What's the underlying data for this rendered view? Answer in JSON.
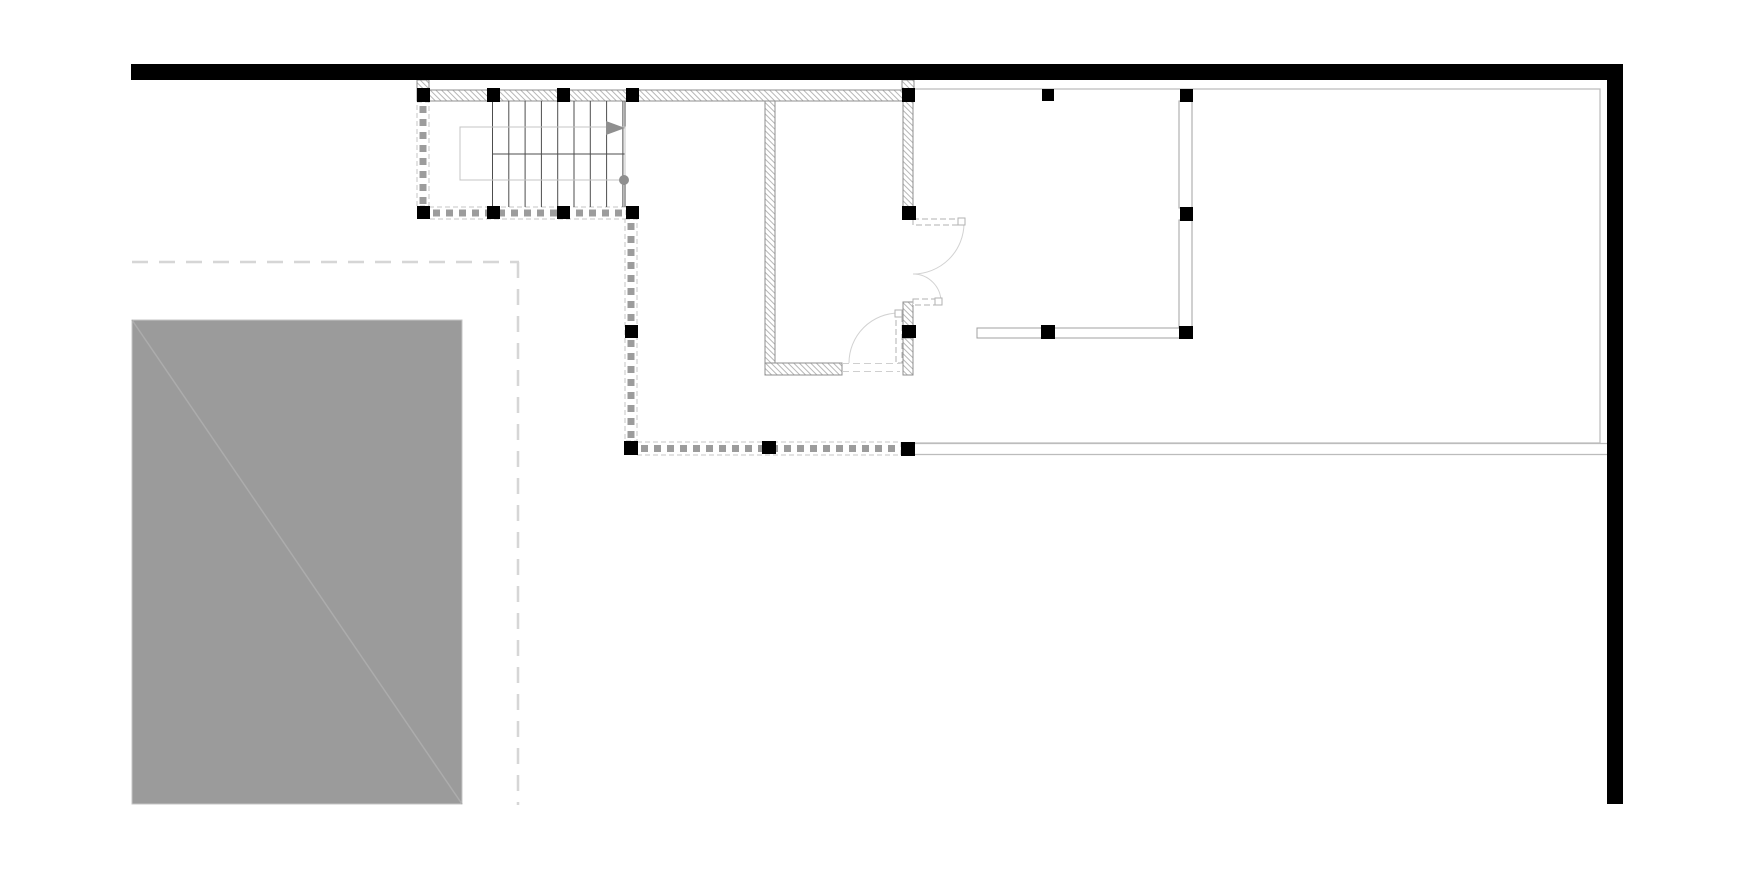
{
  "document": {
    "type": "architectural-floor-plan",
    "background": "#ffffff",
    "canvas": {
      "width": 1754,
      "height": 871
    }
  },
  "colors": {
    "black_wall": "#000000",
    "hatch_line": "#b7b7b7",
    "hatch_border": "#8f8f8f",
    "thin_wall_border": "#a0a0a0",
    "terrace_line": "#bcbcbc",
    "dash_border": "#c4c4c4",
    "dash_square": "#9c9c9c",
    "stair_line": "#4d4d4d",
    "railing_line": "#c4c4c4",
    "marker_gray": "#8f8f8f",
    "door_arc": "#d2d2d2",
    "door_leaf": "#b2b2b2",
    "threshold": "#cfcfcf",
    "site_dash": "#d6d6d6",
    "site_mass_fill": "#9b9b9b",
    "site_mass_diag": "#acacac",
    "site_mass_edge": "#c6c6c6"
  },
  "black_walls": [
    {
      "name": "exterior-wall-top",
      "x": 131,
      "y": 64,
      "w": 1492,
      "h": 16
    },
    {
      "name": "exterior-wall-right",
      "x": 1607,
      "y": 80,
      "w": 16,
      "h": 724
    }
  ],
  "hatched_walls": [
    {
      "name": "wall-connector-left",
      "x": 417,
      "y": 80,
      "w": 12,
      "h": 10
    },
    {
      "name": "wall-connector-mid",
      "x": 902,
      "y": 80,
      "w": 12,
      "h": 10
    },
    {
      "name": "wall-top-interior",
      "x": 417,
      "y": 90,
      "w": 497,
      "h": 11
    },
    {
      "name": "room-wall-left",
      "x": 765,
      "y": 101,
      "w": 10,
      "h": 274
    },
    {
      "name": "room-wall-bottom",
      "x": 765,
      "y": 363,
      "w": 77,
      "h": 12
    },
    {
      "name": "room-wall-right-upper",
      "x": 903,
      "y": 101,
      "w": 10,
      "h": 106
    },
    {
      "name": "room-wall-right-mid",
      "x": 903,
      "y": 302,
      "w": 10,
      "h": 24
    },
    {
      "name": "room-wall-right-lower",
      "x": 903,
      "y": 338,
      "w": 10,
      "h": 37
    }
  ],
  "thin_walls": [
    {
      "name": "partition-right-upper",
      "x": 1179,
      "y": 101,
      "w": 13,
      "h": 107
    },
    {
      "name": "partition-right-lower",
      "x": 1179,
      "y": 220,
      "w": 13,
      "h": 107
    },
    {
      "name": "partition-bottom",
      "x": 977,
      "y": 328,
      "w": 203,
      "h": 10
    }
  ],
  "terrace": {
    "outline": {
      "x": 914,
      "y": 89,
      "w": 686,
      "h": 354
    },
    "parapet_lines": [
      {
        "x1": 914,
        "y1": 443.5,
        "x2": 1607,
        "y2": 443.5
      },
      {
        "x1": 914,
        "y1": 454.5,
        "x2": 1607,
        "y2": 454.5
      }
    ]
  },
  "dashed_bands": [
    {
      "name": "dashed-wall-stair-left",
      "x": 417,
      "y": 102,
      "w": 12,
      "h": 104,
      "orient": "v"
    },
    {
      "name": "dashed-wall-stair-bottom",
      "x": 429,
      "y": 207,
      "w": 197,
      "h": 12,
      "orient": "h"
    },
    {
      "name": "dashed-wall-court-left",
      "x": 625,
      "y": 219,
      "w": 12,
      "h": 222,
      "orient": "v"
    },
    {
      "name": "dashed-wall-court-bottom",
      "x": 637,
      "y": 442,
      "w": 264,
      "h": 13,
      "orient": "h"
    }
  ],
  "columns": [
    {
      "x": 417,
      "y": 88,
      "w": 13,
      "h": 14
    },
    {
      "x": 487,
      "y": 88,
      "w": 13,
      "h": 14
    },
    {
      "x": 557,
      "y": 88,
      "w": 13,
      "h": 14
    },
    {
      "x": 626,
      "y": 88,
      "w": 13,
      "h": 14
    },
    {
      "x": 902,
      "y": 88,
      "w": 13,
      "h": 14
    },
    {
      "x": 1042,
      "y": 89,
      "w": 12,
      "h": 12
    },
    {
      "x": 1180,
      "y": 89,
      "w": 13,
      "h": 13
    },
    {
      "x": 417,
      "y": 206,
      "w": 13,
      "h": 13
    },
    {
      "x": 487,
      "y": 206,
      "w": 13,
      "h": 13
    },
    {
      "x": 557,
      "y": 206,
      "w": 13,
      "h": 13
    },
    {
      "x": 626,
      "y": 206,
      "w": 13,
      "h": 13
    },
    {
      "x": 902,
      "y": 206,
      "w": 14,
      "h": 14
    },
    {
      "x": 1180,
      "y": 207,
      "w": 13,
      "h": 14
    },
    {
      "x": 625,
      "y": 325,
      "w": 13,
      "h": 13
    },
    {
      "x": 902,
      "y": 325,
      "w": 14,
      "h": 13
    },
    {
      "x": 1041,
      "y": 325,
      "w": 14,
      "h": 14
    },
    {
      "x": 1179,
      "y": 326,
      "w": 14,
      "h": 13
    },
    {
      "x": 624,
      "y": 441,
      "w": 14,
      "h": 14
    },
    {
      "x": 762,
      "y": 441,
      "w": 14,
      "h": 13
    },
    {
      "x": 901,
      "y": 442,
      "w": 14,
      "h": 14
    }
  ],
  "stairs": {
    "treads": {
      "x_start": 492.5,
      "step": 16.3,
      "count": 9,
      "y1": 101,
      "y2": 207
    },
    "mid_line": {
      "x1": 492,
      "y1": 154,
      "x2": 625,
      "y2": 154
    },
    "right_edge": {
      "x1": 625,
      "y1": 101,
      "x2": 625,
      "y2": 207
    },
    "railing": {
      "x": 460,
      "y": 127,
      "w": 165,
      "h": 53
    },
    "direction_arrow": {
      "points": "606,121 625,128 606,135"
    },
    "start_marker": {
      "cx": 624,
      "cy": 180,
      "r": 5
    }
  },
  "doors": [
    {
      "name": "door-upper",
      "leaf": {
        "x": 913,
        "y": 219,
        "w": 51,
        "h": 6
      },
      "tip": {
        "x": 958,
        "y": 218,
        "w": 7,
        "h": 7
      },
      "arc": "M 964 223 A 51 51 0 0 1 913 274"
    },
    {
      "name": "door-mid",
      "leaf": {
        "x": 913,
        "y": 299,
        "w": 28,
        "h": 6
      },
      "tip": {
        "x": 935,
        "y": 298,
        "w": 7,
        "h": 7
      },
      "arc": "M 941 302 A 28 28 0 0 0 913 274"
    },
    {
      "name": "door-bottom",
      "leaf": {
        "x": 896,
        "y": 313,
        "w": 6,
        "h": 50
      },
      "tip": {
        "x": 895,
        "y": 310,
        "w": 7,
        "h": 7
      },
      "arc": "M 899 313 A 50 50 0 0 0 849 363"
    }
  ],
  "thresholds": [
    {
      "x1": 842,
      "y1": 363.5,
      "x2": 900,
      "y2": 363.5
    },
    {
      "x1": 842,
      "y1": 371.5,
      "x2": 900,
      "y2": 371.5
    }
  ],
  "site": {
    "boundary_h": {
      "x1": 132,
      "y1": 262,
      "x2": 519,
      "y2": 262
    },
    "boundary_v": {
      "x1": 518,
      "y1": 262,
      "x2": 518,
      "y2": 805
    },
    "mass": {
      "x": 132,
      "y": 320,
      "w": 330,
      "h": 484
    },
    "diagonal": {
      "x1": 132,
      "y1": 320,
      "x2": 462,
      "y2": 804
    }
  }
}
